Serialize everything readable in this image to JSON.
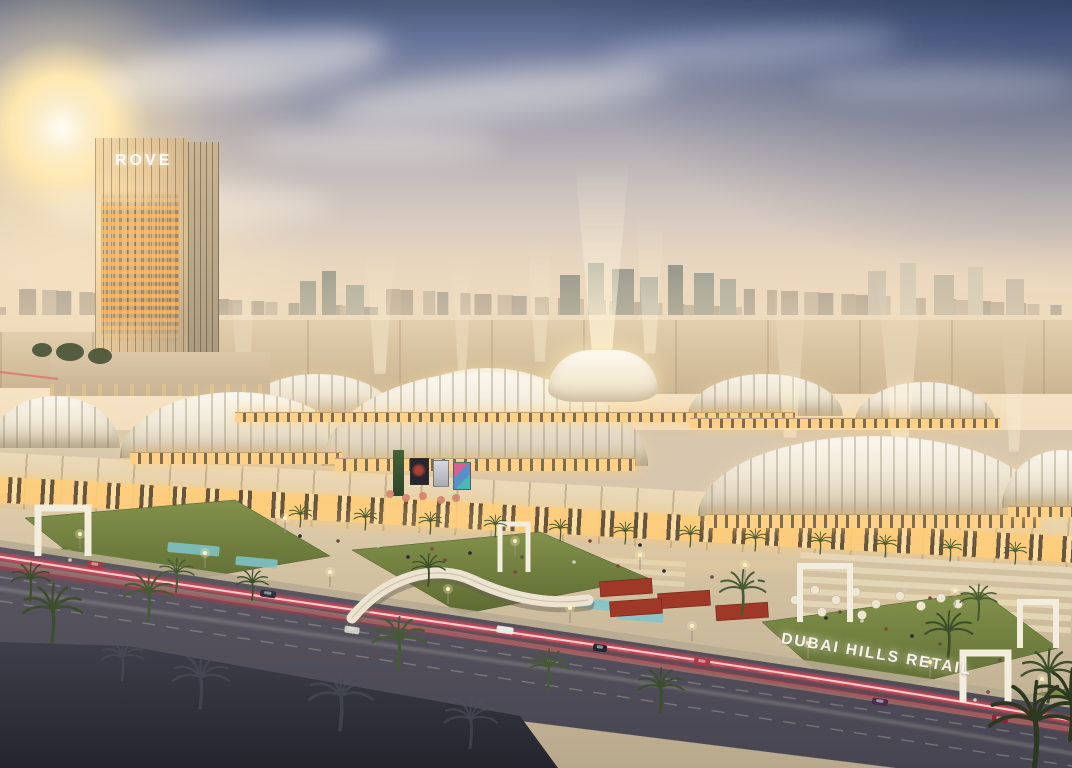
{
  "scene": {
    "description": "Dusk aerial rendering of a large retail mall with vaulted glass roofs, light beams, a hotel tower, palm-lined boulevard and landscaped promenade",
    "tower_sign": "ROVE",
    "ground_sign": "DUBAI HILLS RETAIL"
  },
  "colors": {
    "sky_top": "#49597a",
    "sky_horizon": "#f6e3c4",
    "sun_core": "#fffdf4",
    "sun_halo": "#ffe8b0",
    "city_haze": "#cbbca8",
    "roof_white": "#f4eedd",
    "window_glow": "#ffd188",
    "facade_beige": "#e6d3b0",
    "lawn_green": "#76853f",
    "asphalt": "#4f4d58",
    "tail_light_red": "#ff4552",
    "dark_roof": "#32333d",
    "palm_green": "#3c4e2b",
    "sign_white": "#f8f5ee"
  }
}
